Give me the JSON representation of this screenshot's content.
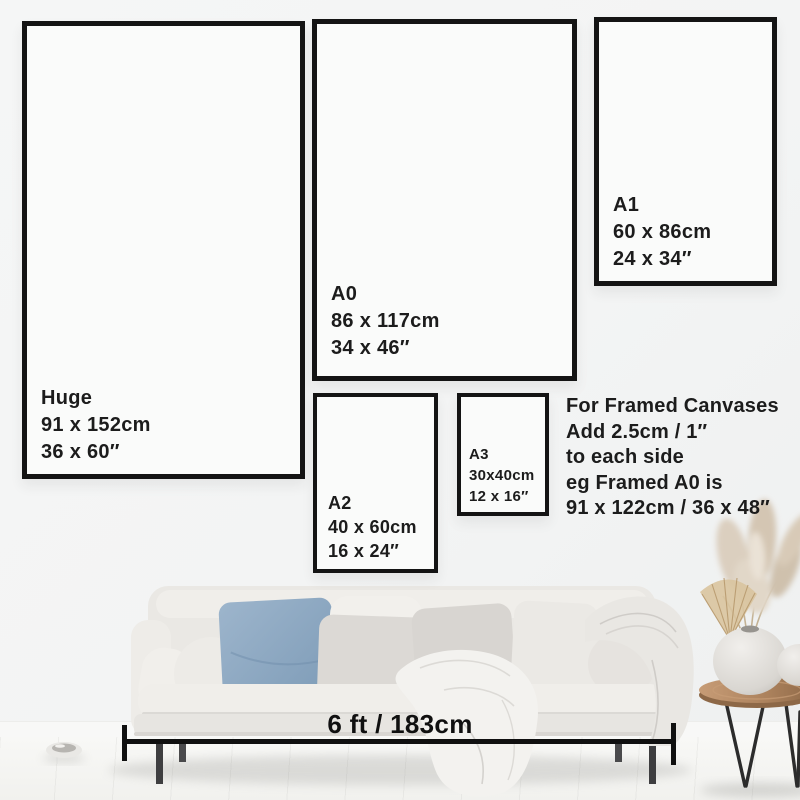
{
  "frames": {
    "huge": {
      "label": "Huge",
      "cm": "91 x 152cm",
      "inches": "36 x 60″"
    },
    "a0": {
      "label": "A0",
      "cm": "86 x 117cm",
      "inches": "34 x 46″"
    },
    "a1": {
      "label": "A1",
      "cm": "60 x 86cm",
      "inches": "24 x 34″"
    },
    "a2": {
      "label": "A2",
      "cm": "40 x 60cm",
      "inches": "16 x 24″"
    },
    "a3": {
      "label": "A3",
      "cm": "30x40cm",
      "inches": "12 x 16″"
    }
  },
  "info": {
    "lines": [
      "For Framed Canvases",
      "Add 2.5cm / 1″",
      "to each side",
      "eg Framed A0 is",
      "91 x 122cm / 36 x 48″"
    ]
  },
  "measurement": {
    "label": "6 ft / 183cm"
  },
  "colors": {
    "frame_border": "#141414",
    "text": "#1c1c1c",
    "wall": "#f3f4f5",
    "accent_pillow_blue": "#8aa6c1",
    "sofa": "#eae8e4",
    "wood_table": "#a97e58",
    "pampas": "#d6c8b4"
  }
}
